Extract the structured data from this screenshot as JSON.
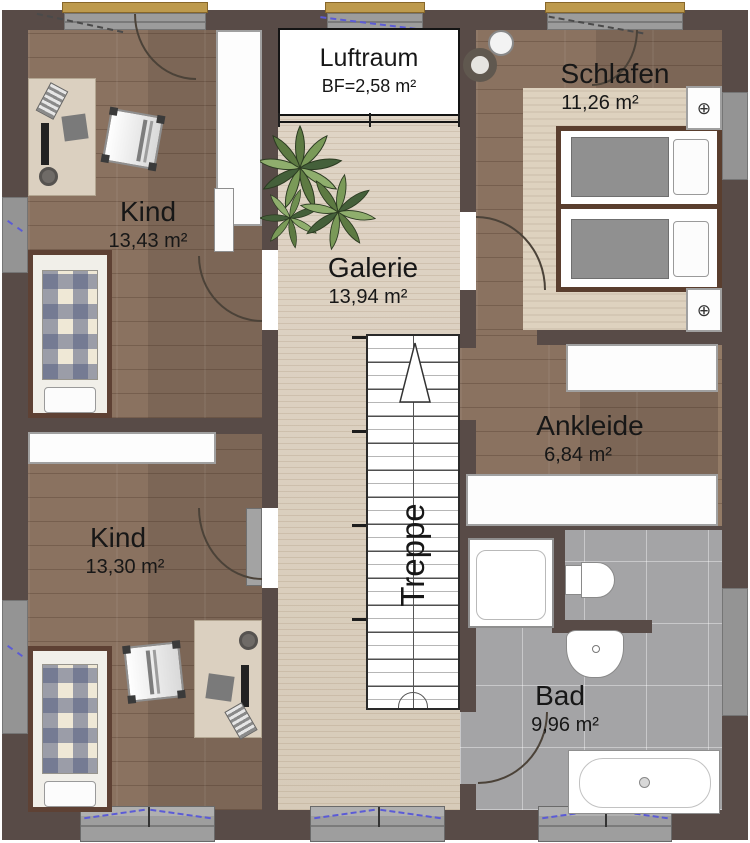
{
  "plan": {
    "rooms": {
      "luftraum": {
        "label": "Luftraum",
        "area": "BF=2,58 m²"
      },
      "schlafen": {
        "label": "Schlafen",
        "area": "11,26 m²"
      },
      "kind_top": {
        "label": "Kind",
        "area": "13,43 m²"
      },
      "galerie": {
        "label": "Galerie",
        "area": "13,94 m²"
      },
      "ankleide": {
        "label": "Ankleide",
        "area": "6,84 m²"
      },
      "kind_bottom": {
        "label": "Kind",
        "area": "13,30 m²"
      },
      "bad": {
        "label": "Bad",
        "area": "9,96 m²"
      },
      "treppe": {
        "label": "Treppe"
      }
    },
    "icons": {
      "nightstand_knob": "⊕"
    },
    "colors": {
      "wall": "#584b47",
      "floor_dark_wood": "#87705f",
      "floor_light_wood": "#dcd1c2",
      "bath_tile": "#a4a4a6",
      "rug": "#ded2bf",
      "window_frame_yellow": "#bd9a4d",
      "window_sill_gray": "#9c9c9c",
      "marking_blue": "#5b5bd6",
      "plaid_blue": "#565f82",
      "bed_frame_brown": "#5e4134",
      "plant_green": "#6f8f50"
    }
  }
}
